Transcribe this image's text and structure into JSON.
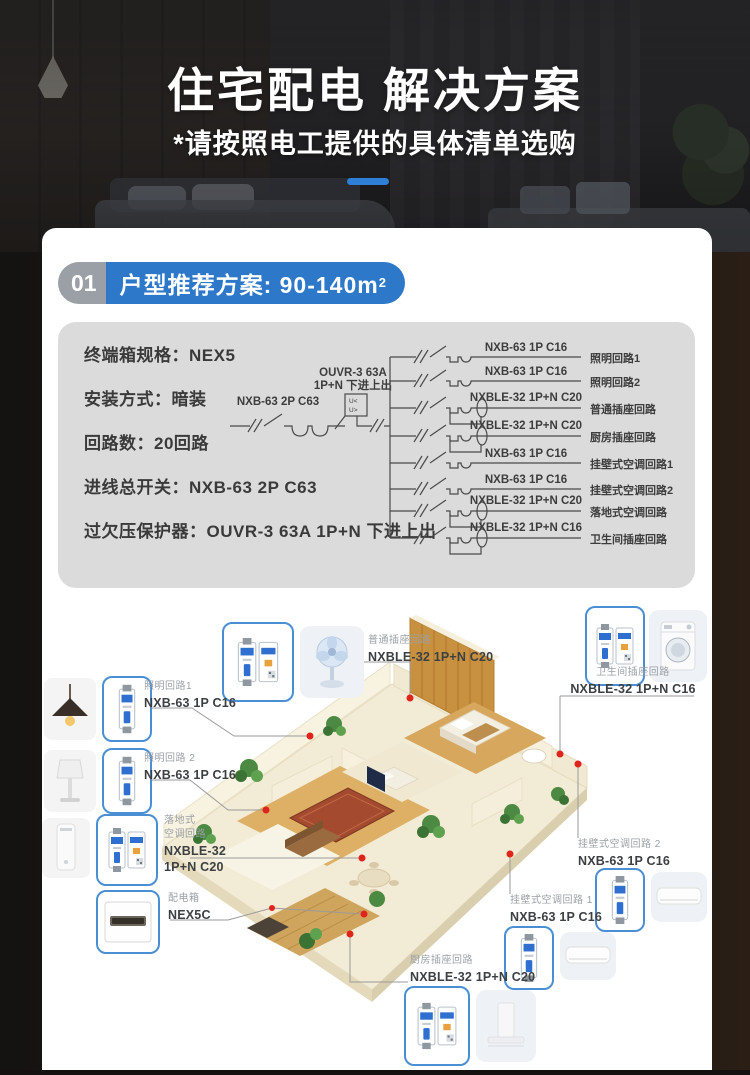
{
  "header": {
    "title": "住宅配电 解决方案",
    "subtitle": "*请按照电工提供的具体清单选购"
  },
  "section": {
    "number": "01",
    "title": "户型推荐方案: 90-140m",
    "title_sup": "2"
  },
  "specs": [
    "终端箱规格：NEX5",
    "安装方式：暗装",
    "回路数：20回路",
    "进线总开关：NXB-63 2P C63",
    "过欠压保护器：OUVR-3 63A 1P+N 下进上出"
  ],
  "diagram": {
    "main_breaker": "NXB-63 2P C63",
    "protector_line1": "OUVR-3 63A",
    "protector_line2": "1P+N 下进上出",
    "u_less": "U<",
    "u_greater": "U>",
    "circuits": [
      {
        "model": "NXB-63 1P C16",
        "name": "照明回路1"
      },
      {
        "model": "NXB-63 1P C16",
        "name": "照明回路2"
      },
      {
        "model": "NXBLE-32 1P+N C20",
        "name": "普通插座回路"
      },
      {
        "model": "NXBLE-32 1P+N C20",
        "name": "厨房插座回路"
      },
      {
        "model": "NXB-63 1P C16",
        "name": "挂壁式空调回路1"
      },
      {
        "model": "NXB-63 1P C16",
        "name": "挂壁式空调回路2"
      },
      {
        "model": "NXBLE-32 1P+N C20",
        "name": "落地式空调回路"
      },
      {
        "model": "NXBLE-32 1P+N C16",
        "name": "卫生间插座回路"
      }
    ]
  },
  "callouts": {
    "socket_general": {
      "name": "普通插座回路",
      "model": "NXBLE-32 1P+N C20"
    },
    "bathroom": {
      "name": "卫生间插座回路",
      "model": "NXBLE-32 1P+N C16"
    },
    "lighting1": {
      "name": "照明回路1",
      "model": "NXB-63 1P C16"
    },
    "lighting2": {
      "name": "照明回路 2",
      "model": "NXB-63 1P C16"
    },
    "floor_ac": {
      "name_line1": "落地式",
      "name_line2": "空调回路",
      "model_line1": "NXBLE-32",
      "model_line2": "1P+N C20"
    },
    "dist_box": {
      "name": "配电箱",
      "model": "NEX5C"
    },
    "wall_ac2": {
      "name": "挂壁式空调回路 2",
      "model": "NXB-63 1P C16"
    },
    "wall_ac1": {
      "name": "挂壁式空调回路 1",
      "model": "NXB-63 1P C16"
    },
    "kitchen": {
      "name": "厨房插座回路",
      "model": "NXBLE-32 1P+N C20"
    }
  }
}
